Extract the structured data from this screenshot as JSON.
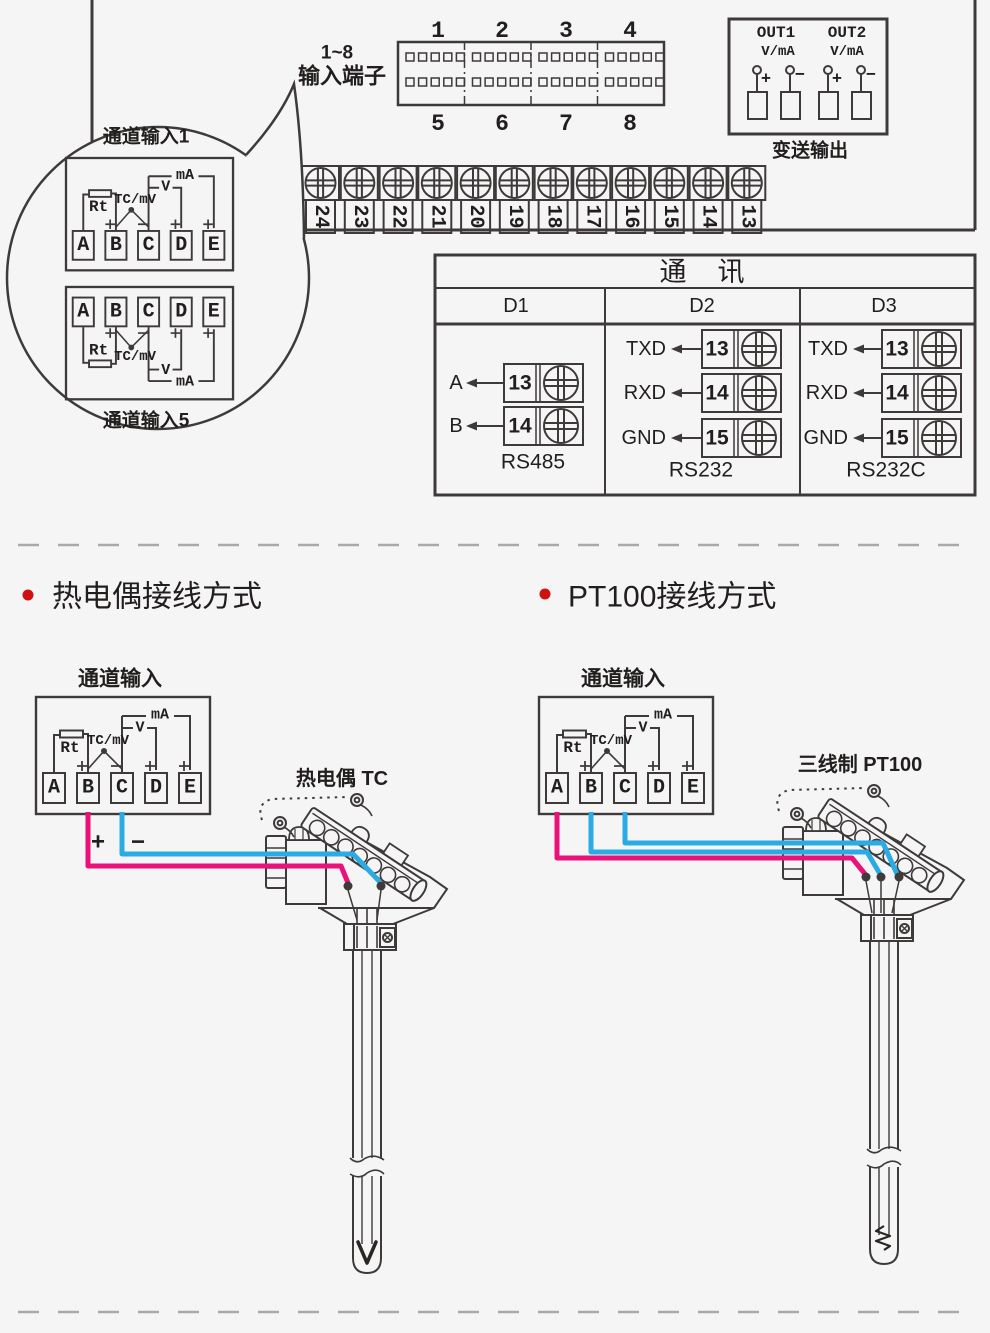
{
  "panel": {
    "connector": {
      "label_range": "1~8",
      "label_name": "输入端子",
      "top_numbers": [
        "1",
        "2",
        "3",
        "4"
      ],
      "bottom_numbers": [
        "5",
        "6",
        "7",
        "8"
      ]
    },
    "out_box": {
      "out1": "OUT1",
      "out2": "OUT2",
      "vma": "V/mA",
      "plus": "+",
      "minus": "−",
      "caption": "变送输出"
    },
    "strip": {
      "numbers": [
        "24",
        "23",
        "22",
        "21",
        "20",
        "19",
        "18",
        "17",
        "16",
        "15",
        "14",
        "13"
      ]
    }
  },
  "bubble": {
    "title_top": "通道输入1",
    "title_bottom": "通道输入5"
  },
  "chan": {
    "terminals": [
      "A",
      "B",
      "C",
      "D",
      "E"
    ],
    "rt": "Rt",
    "tcmv": "TC/mV",
    "v": "V",
    "ma": "mA"
  },
  "comm": {
    "title": "通　讯",
    "columns": [
      {
        "name": "D1",
        "caption": "RS485",
        "rows": [
          {
            "label": "A",
            "num": "13"
          },
          {
            "label": "B",
            "num": "14"
          }
        ]
      },
      {
        "name": "D2",
        "caption": "RS232",
        "rows": [
          {
            "label": "TXD",
            "num": "13"
          },
          {
            "label": "RXD",
            "num": "14"
          },
          {
            "label": "GND",
            "num": "15"
          }
        ]
      },
      {
        "name": "D3",
        "caption": "RS232C",
        "rows": [
          {
            "label": "TXD",
            "num": "13"
          },
          {
            "label": "RXD",
            "num": "14"
          },
          {
            "label": "GND",
            "num": "15"
          }
        ]
      }
    ]
  },
  "sections": {
    "left": {
      "heading": "热电偶接线方式",
      "box_title": "通道输入",
      "probe_label": "热电偶 TC",
      "plus": "+",
      "minus": "−"
    },
    "right": {
      "heading": "PT100接线方式",
      "box_title": "通道输入",
      "probe_label": "三线制 PT100"
    }
  },
  "colors": {
    "wire_pink": "#ea1178",
    "wire_blue": "#2aabe3",
    "bullet_red": "#cf1110",
    "line": "#3e3a39",
    "background": "#f5f5f6"
  }
}
